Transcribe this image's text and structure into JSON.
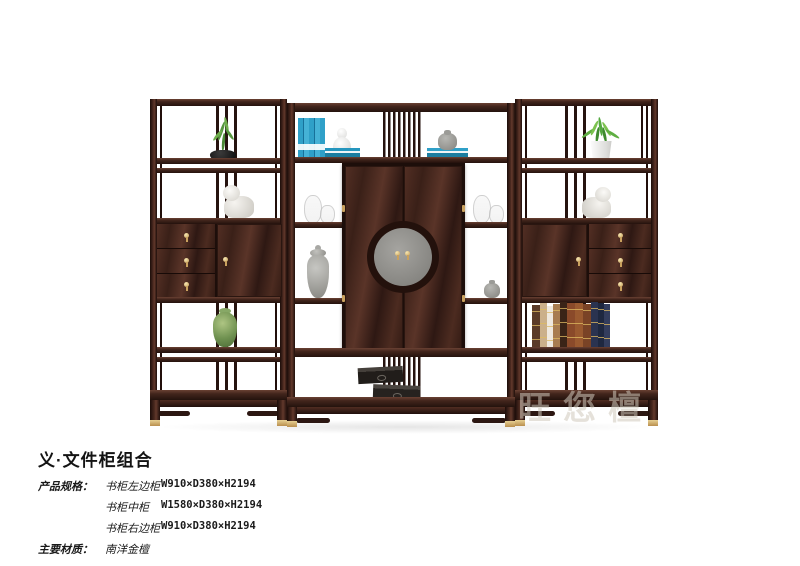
{
  "caption": {
    "title": "义·文件柜组合",
    "product_spec_label": "产品规格：",
    "specs": [
      {
        "name": "书柜左边柜",
        "dimensions": "W910×D380×H2194"
      },
      {
        "name": "书柜中柜",
        "dimensions": "W1580×D380×H2194"
      },
      {
        "name": "书柜右边柜",
        "dimensions": "W910×D380×H2194"
      }
    ],
    "material_label": "主要材质：",
    "material_value": "南洋金檀"
  },
  "watermark": "旺您檀",
  "palette": {
    "wood_dark": "#24120d",
    "wood_mid": "#42251c",
    "wood_light": "#6a4133",
    "brass": "#c9a15e",
    "medallion_grey": "#8e8d89",
    "book_blue": "#2596be",
    "plant_green": "#57973f",
    "vase_green": "#6f9150",
    "statue_white": "#efede8",
    "box_black": "#211d1a",
    "jar_grey": "#9b9b97"
  }
}
